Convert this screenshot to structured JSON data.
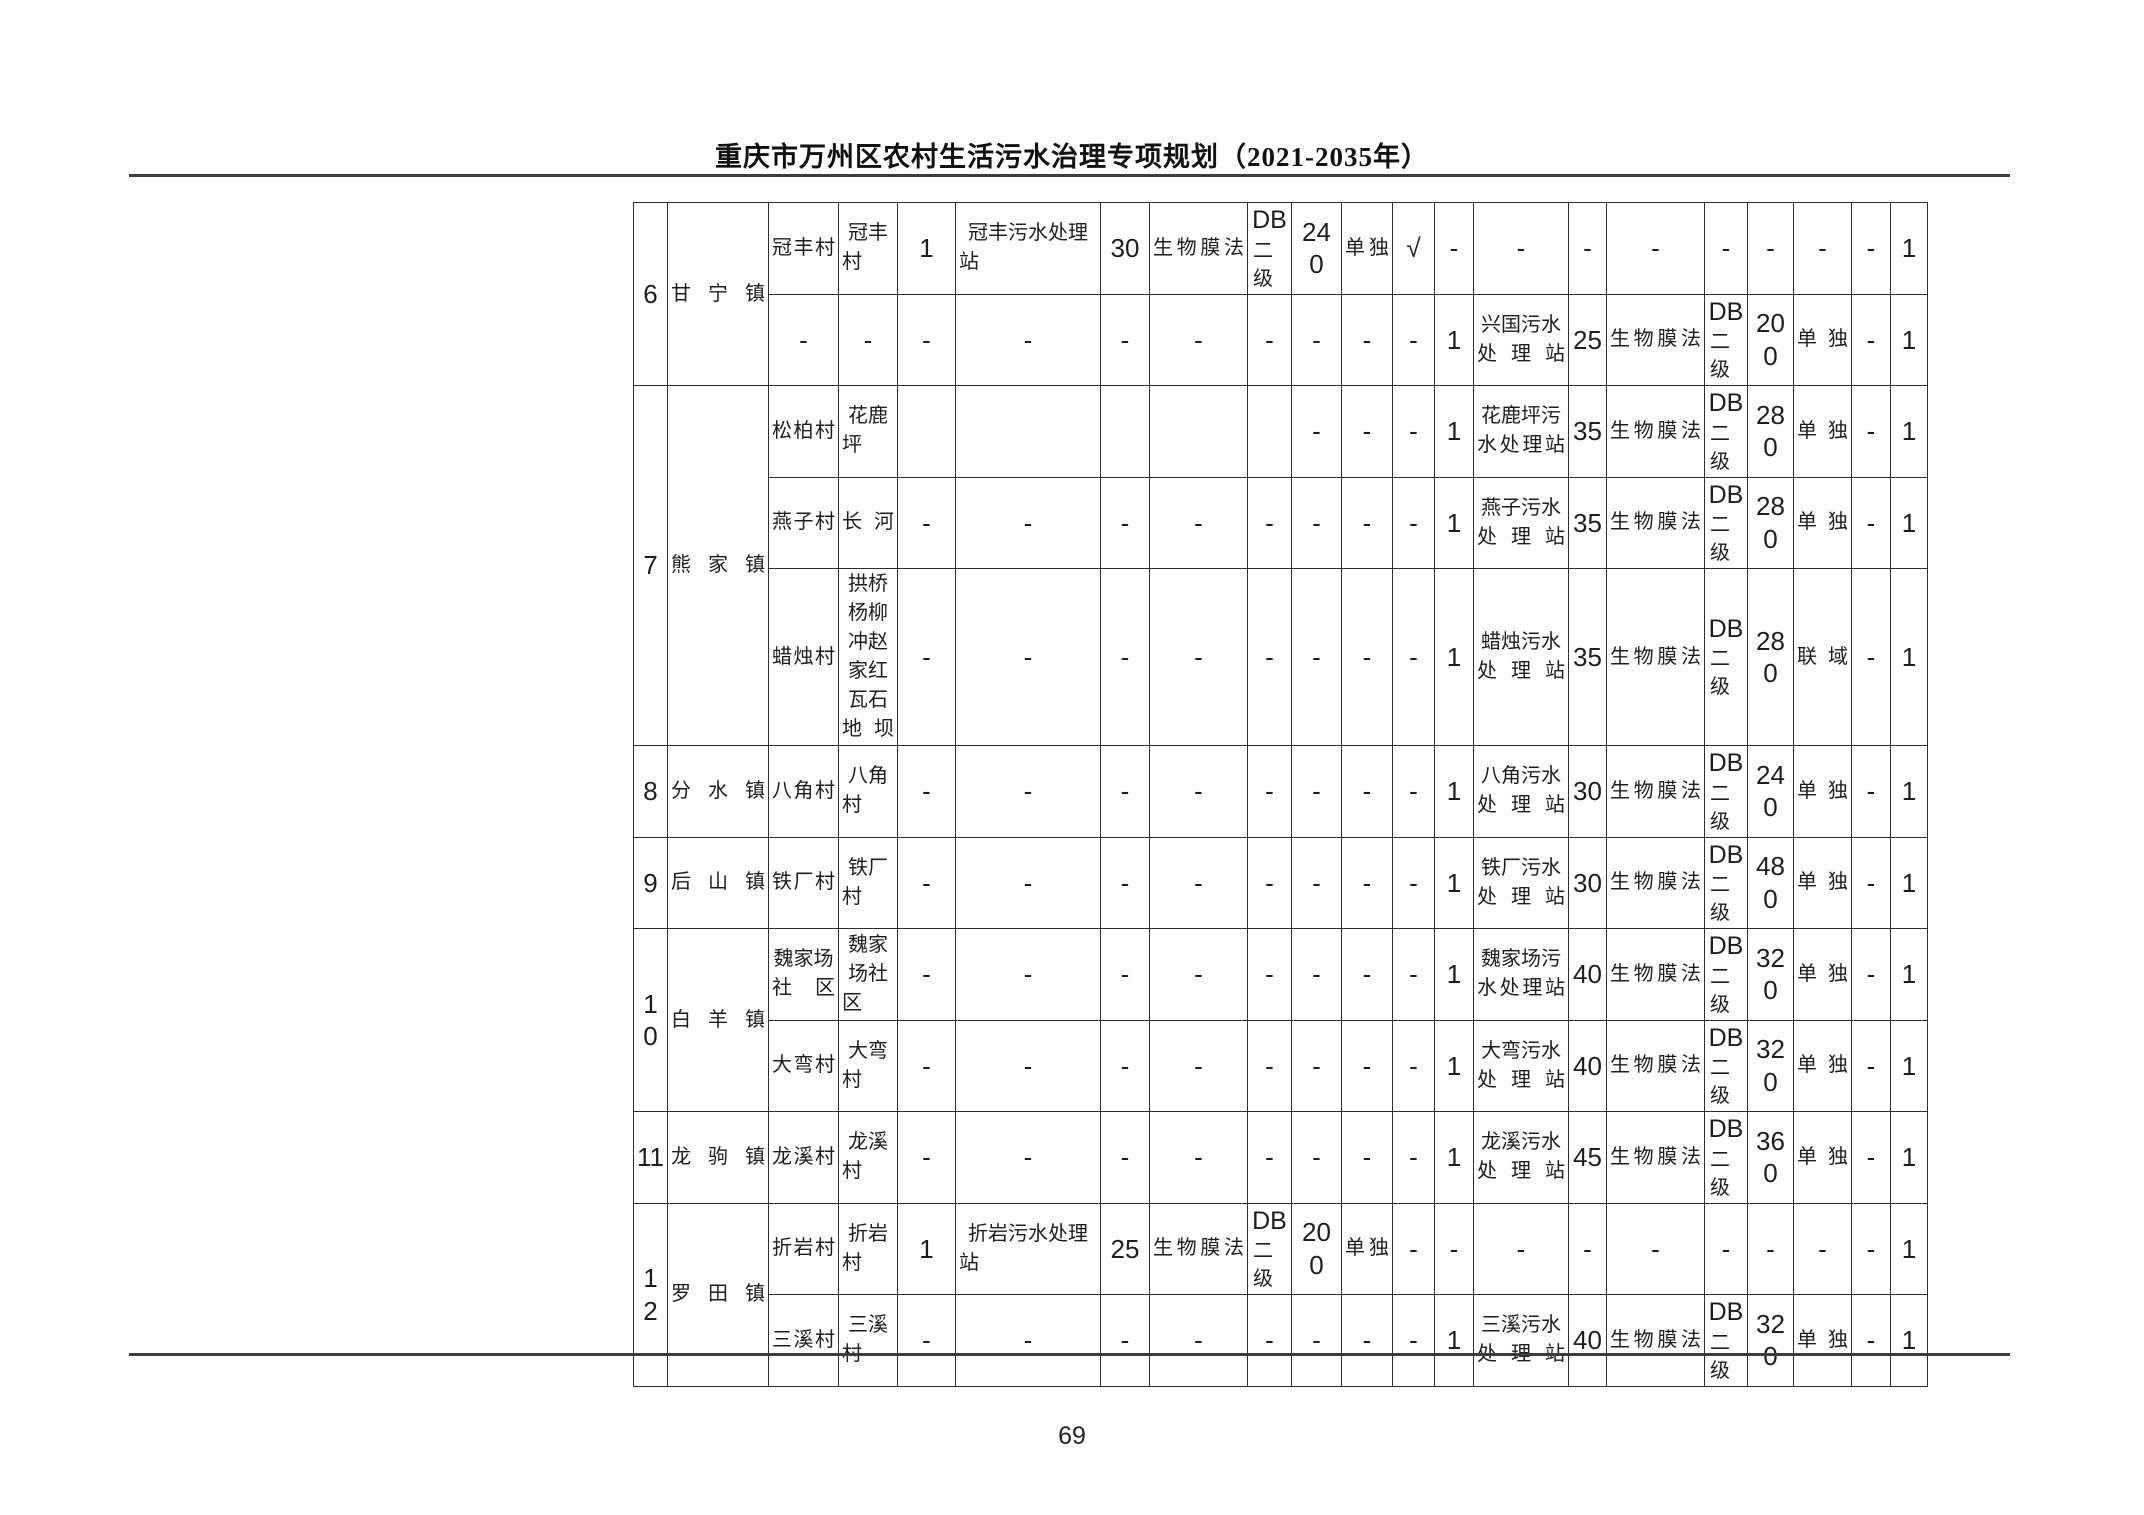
{
  "header": {
    "title": "重庆市万州区农村生活污水治理专项规划（2021-2035年）"
  },
  "footer": {
    "page_number": "69"
  },
  "table": {
    "rows": [
      {
        "cells": [
          {
            "t": "6",
            "rs": 2
          },
          {
            "t": "甘宁镇",
            "rs": 2
          },
          {
            "t": "冠丰村"
          },
          {
            "t": "冠丰村"
          },
          {
            "t": "1"
          },
          {
            "t": "冠丰污水处理站"
          },
          {
            "t": "30"
          },
          {
            "t": "生物膜法"
          },
          {
            "t": "DB\n二级"
          },
          {
            "t": "240"
          },
          {
            "t": "单独"
          },
          {
            "t": "√"
          },
          {
            "t": "-"
          },
          {
            "t": "-"
          },
          {
            "t": "-"
          },
          {
            "t": "-"
          },
          {
            "t": "-"
          },
          {
            "t": "-"
          },
          {
            "t": "-"
          },
          {
            "t": "-"
          },
          {
            "t": "1"
          }
        ]
      },
      {
        "cells": [
          {
            "t": "-"
          },
          {
            "t": "-"
          },
          {
            "t": "-"
          },
          {
            "t": "-"
          },
          {
            "t": "-"
          },
          {
            "t": "-"
          },
          {
            "t": "-"
          },
          {
            "t": "-"
          },
          {
            "t": "-"
          },
          {
            "t": "-"
          },
          {
            "t": "1"
          },
          {
            "t": "兴国污水处理站"
          },
          {
            "t": "25"
          },
          {
            "t": "生物膜法"
          },
          {
            "t": "DB\n二级"
          },
          {
            "t": "200"
          },
          {
            "t": "单独"
          },
          {
            "t": "-"
          },
          {
            "t": "1"
          }
        ]
      },
      {
        "cells": [
          {
            "t": "7",
            "rs": 3
          },
          {
            "t": "熊家镇",
            "rs": 3
          },
          {
            "t": "松柏村"
          },
          {
            "t": "花鹿坪"
          },
          {
            "t": ""
          },
          {
            "t": ""
          },
          {
            "t": ""
          },
          {
            "t": ""
          },
          {
            "t": ""
          },
          {
            "t": "-"
          },
          {
            "t": "-"
          },
          {
            "t": "-"
          },
          {
            "t": "1"
          },
          {
            "t": "花鹿坪污水处理站"
          },
          {
            "t": "35"
          },
          {
            "t": "生物膜法"
          },
          {
            "t": "DB\n二级"
          },
          {
            "t": "280"
          },
          {
            "t": "单独"
          },
          {
            "t": "-"
          },
          {
            "t": "1"
          }
        ]
      },
      {
        "cells": [
          {
            "t": "燕子村"
          },
          {
            "t": "长河"
          },
          {
            "t": "-"
          },
          {
            "t": "-"
          },
          {
            "t": "-"
          },
          {
            "t": "-"
          },
          {
            "t": "-"
          },
          {
            "t": "-"
          },
          {
            "t": "-"
          },
          {
            "t": "-"
          },
          {
            "t": "1"
          },
          {
            "t": "燕子污水处理站"
          },
          {
            "t": "35"
          },
          {
            "t": "生物膜法"
          },
          {
            "t": "DB\n二级"
          },
          {
            "t": "280"
          },
          {
            "t": "单独"
          },
          {
            "t": "-"
          },
          {
            "t": "1"
          }
        ]
      },
      {
        "cells": [
          {
            "t": "蜡烛村"
          },
          {
            "t": "拱桥杨柳冲赵家红瓦石地坝"
          },
          {
            "t": "-"
          },
          {
            "t": "-"
          },
          {
            "t": "-"
          },
          {
            "t": "-"
          },
          {
            "t": "-"
          },
          {
            "t": "-"
          },
          {
            "t": "-"
          },
          {
            "t": "-"
          },
          {
            "t": "1"
          },
          {
            "t": "蜡烛污水处理站"
          },
          {
            "t": "35"
          },
          {
            "t": "生物膜法"
          },
          {
            "t": "DB\n二级"
          },
          {
            "t": "280"
          },
          {
            "t": "联域"
          },
          {
            "t": "-"
          },
          {
            "t": "1"
          }
        ]
      },
      {
        "cells": [
          {
            "t": "8"
          },
          {
            "t": "分水镇"
          },
          {
            "t": "八角村"
          },
          {
            "t": "八角村"
          },
          {
            "t": "-"
          },
          {
            "t": "-"
          },
          {
            "t": "-"
          },
          {
            "t": "-"
          },
          {
            "t": "-"
          },
          {
            "t": "-"
          },
          {
            "t": "-"
          },
          {
            "t": "-"
          },
          {
            "t": "1"
          },
          {
            "t": "八角污水处理站"
          },
          {
            "t": "30"
          },
          {
            "t": "生物膜法"
          },
          {
            "t": "DB\n二级"
          },
          {
            "t": "240"
          },
          {
            "t": "单独"
          },
          {
            "t": "-"
          },
          {
            "t": "1"
          }
        ]
      },
      {
        "cells": [
          {
            "t": "9"
          },
          {
            "t": "后山镇"
          },
          {
            "t": "铁厂村"
          },
          {
            "t": "铁厂村"
          },
          {
            "t": "-"
          },
          {
            "t": "-"
          },
          {
            "t": "-"
          },
          {
            "t": "-"
          },
          {
            "t": "-"
          },
          {
            "t": "-"
          },
          {
            "t": "-"
          },
          {
            "t": "-"
          },
          {
            "t": "1"
          },
          {
            "t": "铁厂污水处理站"
          },
          {
            "t": "30"
          },
          {
            "t": "生物膜法"
          },
          {
            "t": "DB\n二级"
          },
          {
            "t": "480"
          },
          {
            "t": "单独"
          },
          {
            "t": "-"
          },
          {
            "t": "1"
          }
        ]
      },
      {
        "cells": [
          {
            "t": "10",
            "rs": 2
          },
          {
            "t": "白羊镇",
            "rs": 2
          },
          {
            "t": "魏家场社区"
          },
          {
            "t": "魏家场社区"
          },
          {
            "t": "-"
          },
          {
            "t": "-"
          },
          {
            "t": "-"
          },
          {
            "t": "-"
          },
          {
            "t": "-"
          },
          {
            "t": "-"
          },
          {
            "t": "-"
          },
          {
            "t": "-"
          },
          {
            "t": "1"
          },
          {
            "t": "魏家场污水处理站"
          },
          {
            "t": "40"
          },
          {
            "t": "生物膜法"
          },
          {
            "t": "DB\n二级"
          },
          {
            "t": "320"
          },
          {
            "t": "单独"
          },
          {
            "t": "-"
          },
          {
            "t": "1"
          }
        ]
      },
      {
        "cells": [
          {
            "t": "大弯村"
          },
          {
            "t": "大弯村"
          },
          {
            "t": "-"
          },
          {
            "t": "-"
          },
          {
            "t": "-"
          },
          {
            "t": "-"
          },
          {
            "t": "-"
          },
          {
            "t": "-"
          },
          {
            "t": "-"
          },
          {
            "t": "-"
          },
          {
            "t": "1"
          },
          {
            "t": "大弯污水处理站"
          },
          {
            "t": "40"
          },
          {
            "t": "生物膜法"
          },
          {
            "t": "DB\n二级"
          },
          {
            "t": "320"
          },
          {
            "t": "单独"
          },
          {
            "t": "-"
          },
          {
            "t": "1"
          }
        ]
      },
      {
        "cells": [
          {
            "t": "11"
          },
          {
            "t": "龙驹镇"
          },
          {
            "t": "龙溪村"
          },
          {
            "t": "龙溪村"
          },
          {
            "t": "-"
          },
          {
            "t": "-"
          },
          {
            "t": "-"
          },
          {
            "t": "-"
          },
          {
            "t": "-"
          },
          {
            "t": "-"
          },
          {
            "t": "-"
          },
          {
            "t": "-"
          },
          {
            "t": "1"
          },
          {
            "t": "龙溪污水处理站"
          },
          {
            "t": "45"
          },
          {
            "t": "生物膜法"
          },
          {
            "t": "DB\n二级"
          },
          {
            "t": "360"
          },
          {
            "t": "单独"
          },
          {
            "t": "-"
          },
          {
            "t": "1"
          }
        ]
      },
      {
        "cells": [
          {
            "t": "12",
            "rs": 2
          },
          {
            "t": "罗田镇",
            "rs": 2
          },
          {
            "t": "折岩村"
          },
          {
            "t": "折岩村"
          },
          {
            "t": "1"
          },
          {
            "t": "折岩污水处理站"
          },
          {
            "t": "25"
          },
          {
            "t": "生物膜法"
          },
          {
            "t": "DB\n二级"
          },
          {
            "t": "200"
          },
          {
            "t": "单独"
          },
          {
            "t": "-"
          },
          {
            "t": "-"
          },
          {
            "t": "-"
          },
          {
            "t": "-"
          },
          {
            "t": "-"
          },
          {
            "t": "-"
          },
          {
            "t": "-"
          },
          {
            "t": "-"
          },
          {
            "t": "-"
          },
          {
            "t": "1"
          }
        ]
      },
      {
        "cells": [
          {
            "t": "三溪村"
          },
          {
            "t": "三溪村"
          },
          {
            "t": "-"
          },
          {
            "t": "-"
          },
          {
            "t": "-"
          },
          {
            "t": "-"
          },
          {
            "t": "-"
          },
          {
            "t": "-"
          },
          {
            "t": "-"
          },
          {
            "t": "-"
          },
          {
            "t": "1"
          },
          {
            "t": "三溪污水处理站"
          },
          {
            "t": "40"
          },
          {
            "t": "生物膜法"
          },
          {
            "t": "DB\n二级"
          },
          {
            "t": "320"
          },
          {
            "t": "单独"
          },
          {
            "t": "-"
          },
          {
            "t": "1"
          }
        ]
      }
    ]
  }
}
